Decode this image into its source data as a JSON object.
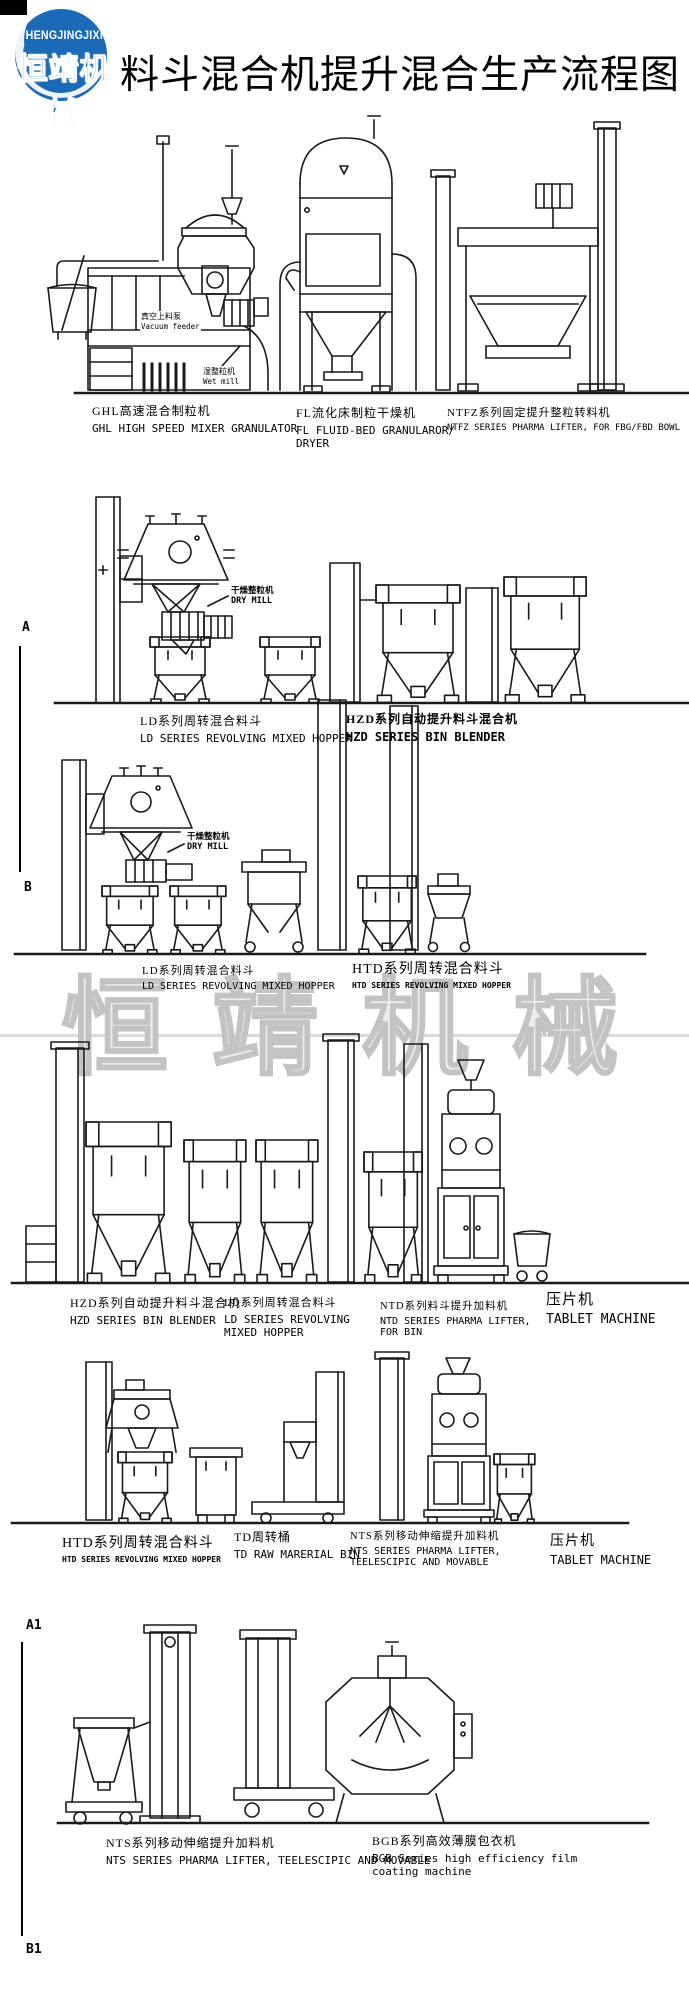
{
  "header": {
    "brand_en": "HENGJINGJIXIE",
    "brand_cn": "恒靖机械",
    "title": "料斗混合机提升混合生产流程图"
  },
  "watermark": "恒靖机械",
  "markers": {
    "a": "A",
    "b": "B",
    "a1": "A1",
    "b1": "B1"
  },
  "inner_labels": {
    "vacuum_feeder_cn": "真空上料泵",
    "vacuum_feeder_en": "Vacuum feeder",
    "wet_mill_cn": "湿整粒机",
    "wet_mill_en": "Wet mill",
    "dry_mill_cn": "干燥整粒机",
    "dry_mill_en": "DRY MILL"
  },
  "rows": [
    {
      "captions": [
        {
          "cn": "GHL高速混合制粒机",
          "en": "GHL HIGH SPEED MIXER GRANULATOR"
        },
        {
          "cn": "FL流化床制粒干燥机",
          "en": "FL FLUID-BED GRANULAROR/ DRYER"
        },
        {
          "cn": "NTFZ系列固定提升整粒转料机",
          "en": "NTFZ SERIES PHARMA LIFTER, FOR FBG/FBD BOWL"
        }
      ]
    },
    {
      "captions": [
        {
          "cn": "LD系列周转混合料斗",
          "en": "LD SERIES REVOLVING MIXED HOPPER"
        },
        {
          "cn": "HZD系列自动提升料斗混合机",
          "en": "HZD SERIES BIN BLENDER"
        }
      ]
    },
    {
      "captions": [
        {
          "cn": "LD系列周转混合料斗",
          "en": "LD SERIES REVOLVING MIXED HOPPER"
        },
        {
          "cn": "HTD系列周转混合料斗",
          "en": "HTD SERIES REVOLVING MIXED HOPPER"
        }
      ]
    },
    {
      "captions": [
        {
          "cn": "HZD系列自动提升料斗混合机",
          "en": "HZD SERIES BIN BLENDER"
        },
        {
          "cn": "LD系列周转混合料斗",
          "en": "LD SERIES REVOLVING MIXED HOPPER"
        },
        {
          "cn": "NTD系列料斗提升加料机",
          "en": "NTD SERIES PHARMA LIFTER, FOR BIN"
        },
        {
          "cn": "压片机",
          "en": "TABLET MACHINE"
        }
      ]
    },
    {
      "captions": [
        {
          "cn": "HTD系列周转混合料斗",
          "en": "HTD SERIES REVOLVING MIXED HOPPER"
        },
        {
          "cn": "TD周转桶",
          "en": "TD RAW MARERIAL BIN"
        },
        {
          "cn": "NTS系列移动伸缩提升加料机",
          "en": "NTS SERIES PHARMA LIFTER, TEELESCIPIC AND MOVABLE"
        },
        {
          "cn": "压片机",
          "en": "TABLET MACHINE"
        }
      ]
    },
    {
      "captions": [
        {
          "cn": "NTS系列移动伸缩提升加料机",
          "en": "NTS SERIES PHARMA LIFTER, TEELESCIPIC AND MOVABLE"
        },
        {
          "cn": "BGB系列高效薄膜包衣机",
          "en": "BGB Series high efficiency film coating machine"
        }
      ]
    }
  ],
  "colors": {
    "brand_blue": "#1b6ab8",
    "ink": "#1a1a1a",
    "watermark": "#c3c3c3"
  }
}
